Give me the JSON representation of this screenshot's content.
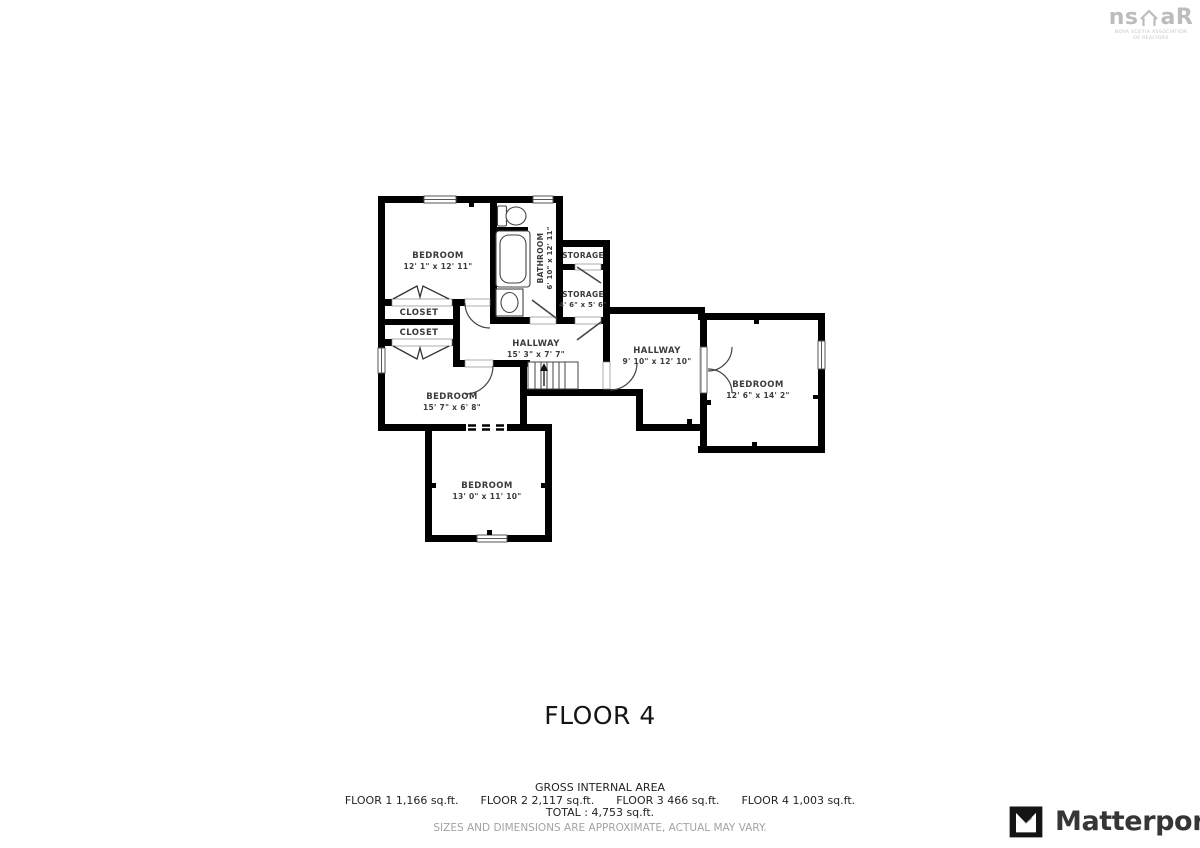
{
  "floor_label": "FLOOR 4",
  "floor_plan": {
    "stairs": {
      "direction": "up"
    },
    "rooms": [
      {
        "id": "bedroom-top-left",
        "name": "BEDROOM",
        "dims": "12' 1\" x 12' 11\""
      },
      {
        "id": "bathroom",
        "name": "BATHROOM",
        "dims": "6' 10\" x 12' 11\""
      },
      {
        "id": "storage-upper",
        "name": "STORAGE",
        "dims": ""
      },
      {
        "id": "storage-lower",
        "name": "STORAGE",
        "dims": "4' 6\" x 5' 6\""
      },
      {
        "id": "closet-upper",
        "name": "CLOSET",
        "dims": ""
      },
      {
        "id": "closet-lower",
        "name": "CLOSET",
        "dims": ""
      },
      {
        "id": "hallway-left",
        "name": "HALLWAY",
        "dims": "15' 3\" x 7' 7\""
      },
      {
        "id": "hallway-right",
        "name": "HALLWAY",
        "dims": "9' 10\" x 12' 10\""
      },
      {
        "id": "bedroom-right",
        "name": "BEDROOM",
        "dims": "12' 6\" x 14' 2\""
      },
      {
        "id": "bedroom-middle",
        "name": "BEDROOM",
        "dims": "15' 7\" x 6' 8\""
      },
      {
        "id": "bedroom-bottom",
        "name": "BEDROOM",
        "dims": "13' 0\" x 11' 10\""
      }
    ]
  },
  "footer": {
    "area_title": "GROSS INTERNAL AREA",
    "floors": [
      "FLOOR 1 1,166 sq.ft.",
      "FLOOR 2 2,117 sq.ft.",
      "FLOOR 3 466 sq.ft.",
      "FLOOR 4 1,003 sq.ft."
    ],
    "total": "TOTAL :  4,753 sq.ft.",
    "disclaimer": "SIZES AND DIMENSIONS ARE APPROXIMATE, ACTUAL MAY VARY."
  },
  "branding": {
    "nsar_left": "ns",
    "nsar_right": "aR",
    "nsar_caption_line1": "NOVA SCOTIA ASSOCIATION",
    "nsar_caption_line2": "OF REALTORS",
    "matterport_wordmark": "Matterport"
  },
  "colors": {
    "wall": "#000000",
    "room_label": "#3b3b3b",
    "disclaimer_gray": "#a3a3a3",
    "nsar_gray": "#bcbcbc",
    "matterport_dark": "#363636"
  }
}
